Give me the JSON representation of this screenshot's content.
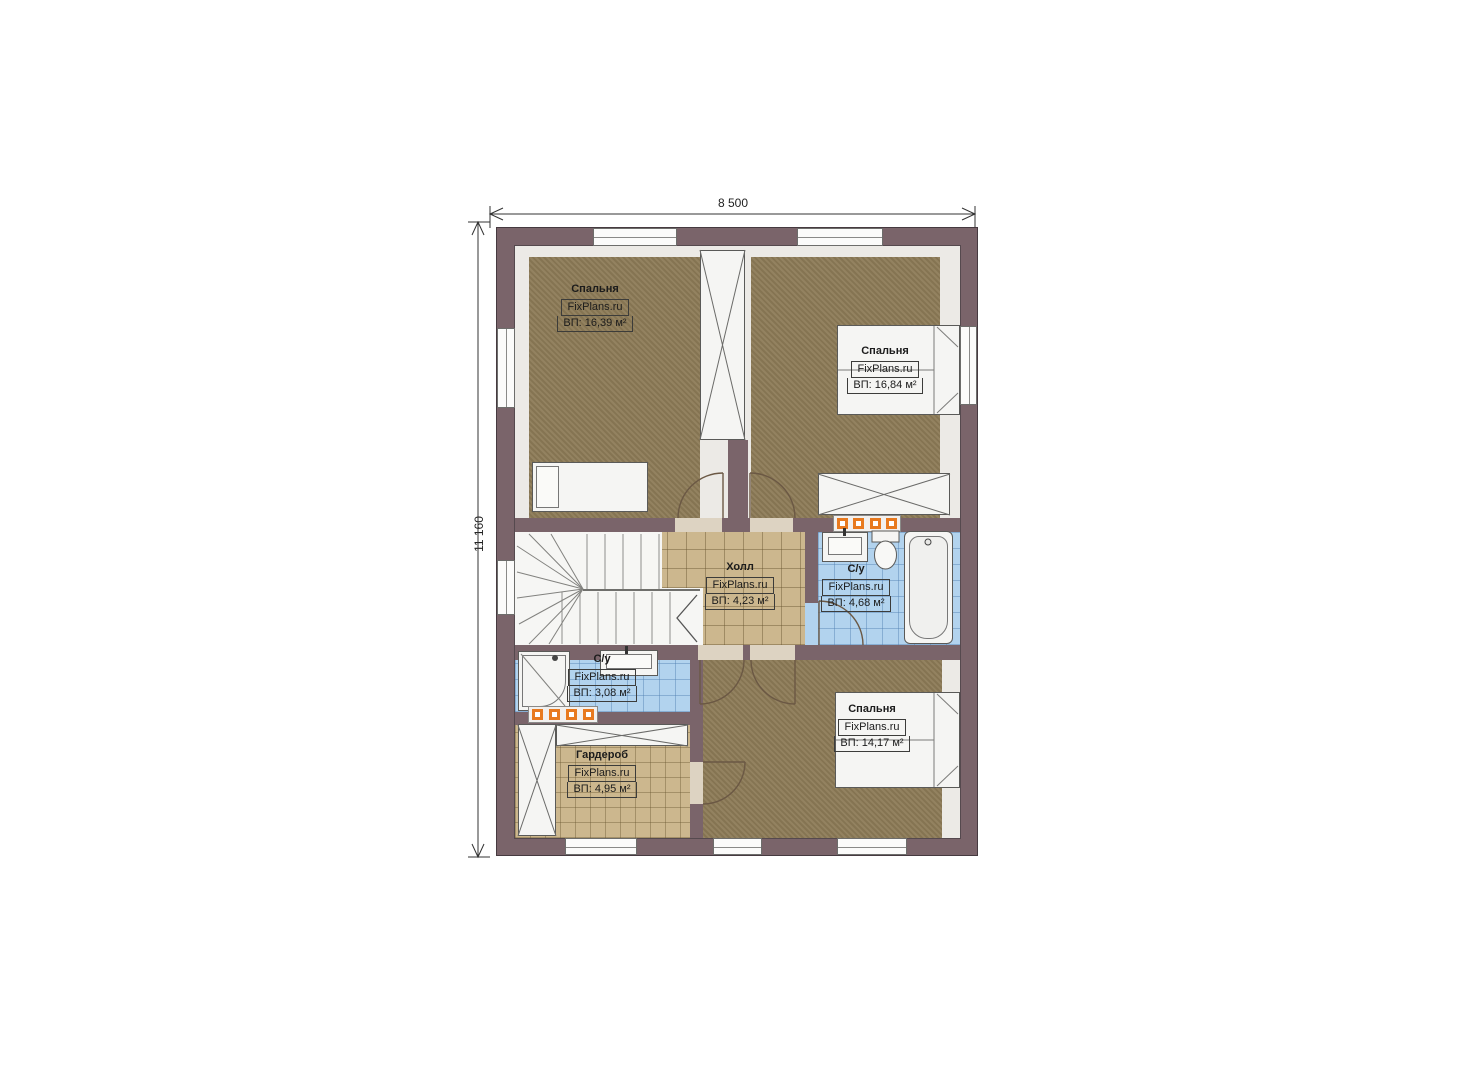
{
  "title": "floor-plan",
  "watermark": "FixPlans.ru",
  "dimensions": {
    "width_label": "8 500",
    "height_label": "11 160"
  },
  "rooms": [
    {
      "id": "bedroom-top-left",
      "name": "Спальня",
      "area": "ВП: 16,39 м²"
    },
    {
      "id": "bedroom-top-right",
      "name": "Спальня",
      "area": "ВП: 16,84 м²"
    },
    {
      "id": "hall",
      "name": "Холл",
      "area": "ВП: 4,23 м²"
    },
    {
      "id": "bathroom-right",
      "name": "С/у",
      "area": "ВП: 4,68 м²"
    },
    {
      "id": "bathroom-left",
      "name": "С/у",
      "area": "ВП: 3,08 м²"
    },
    {
      "id": "wardrobe",
      "name": "Гардероб",
      "area": "ВП: 4,95 м²"
    },
    {
      "id": "bedroom-bottom",
      "name": "Спальня",
      "area": "ВП: 14,17 м²"
    }
  ],
  "colors": {
    "wall": "#7a646a",
    "carpet": "#8d7b57",
    "tile_tan": "#ccb78e",
    "tile_blue": "#b2d3ee",
    "radiator": "#e87a1f",
    "floor_light": "#eceae6"
  }
}
